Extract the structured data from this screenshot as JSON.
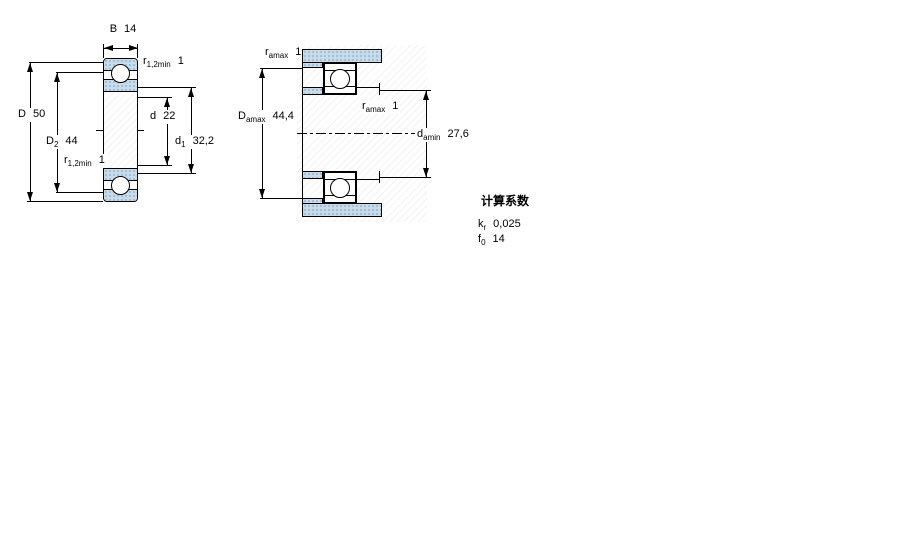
{
  "colors": {
    "line": "#000000",
    "steel_fill": "#c9dbe9",
    "steel_dot": "#84accd",
    "background": "#ffffff"
  },
  "left_drawing": {
    "width_dim": {
      "symbol": "B",
      "sub": "",
      "value": "14"
    },
    "fillet_top": {
      "symbol": "r",
      "sub": "1,2min",
      "value": "1"
    },
    "outer_dia": {
      "symbol": "D",
      "sub": "",
      "value": "50"
    },
    "recess_dia": {
      "symbol": "D",
      "sub": "2",
      "value": "44"
    },
    "fillet_bottom": {
      "symbol": "r",
      "sub": "1,2min",
      "value": "1"
    },
    "bore_dia": {
      "symbol": "d",
      "sub": "",
      "value": "22"
    },
    "shoulder_dia": {
      "symbol": "d",
      "sub": "1",
      "value": "32,2"
    }
  },
  "right_drawing": {
    "fillet_housing": {
      "symbol": "r",
      "sub": "amax",
      "value": "1"
    },
    "housing_shoulder_dia": {
      "symbol": "D",
      "sub": "amax",
      "value": "44,4"
    },
    "fillet_shaft": {
      "symbol": "r",
      "sub": "amax",
      "value": "1"
    },
    "shaft_shoulder_dia": {
      "symbol": "d",
      "sub": "amin",
      "value": "27,6"
    }
  },
  "calculation_factors": {
    "title": "计算系数",
    "rows": [
      {
        "symbol": "k",
        "sub": "r",
        "value": "0,025"
      },
      {
        "symbol": "f",
        "sub": "0",
        "value": "14"
      }
    ]
  }
}
